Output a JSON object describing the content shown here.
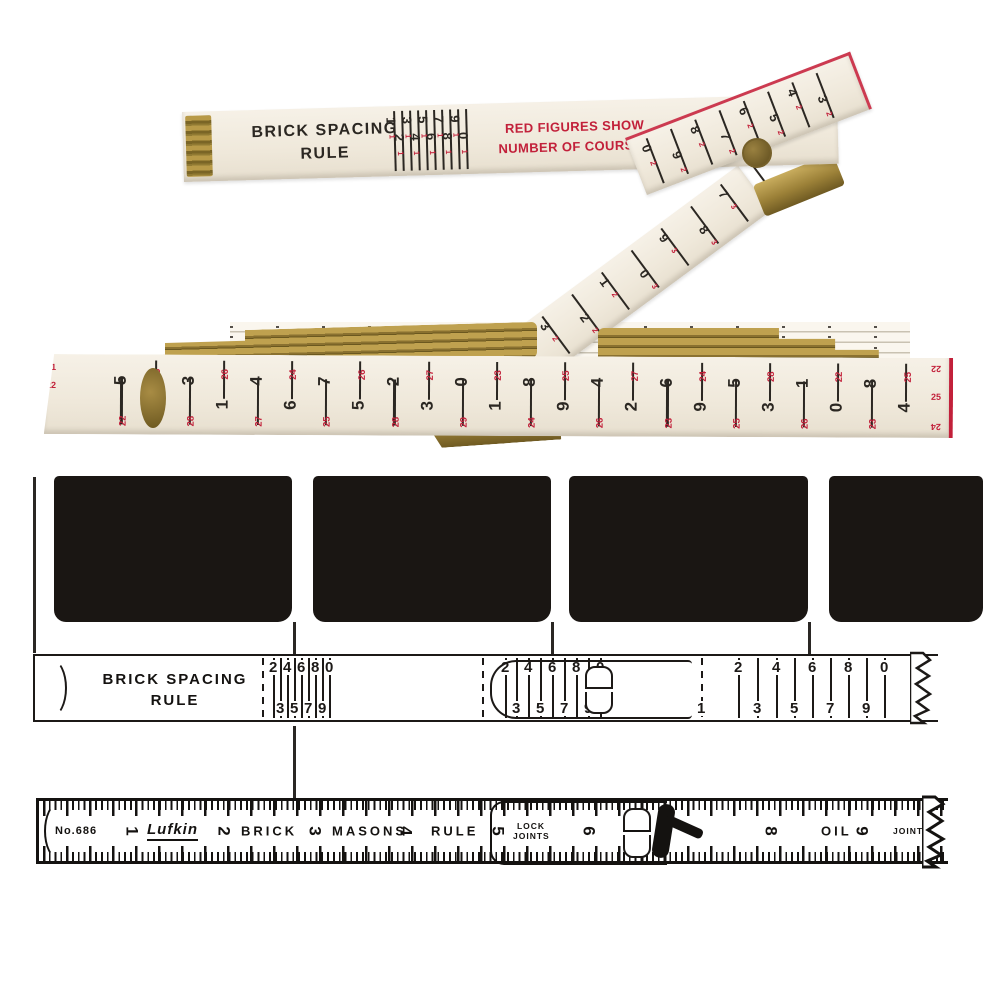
{
  "colors": {
    "ink": "#1c1917",
    "red": "#c2203a",
    "brass": "#a5893d",
    "cream": "#f2ecdf",
    "brick": "#1a1613"
  },
  "photo": {
    "title_line1": "BRICK SPACING",
    "title_line2": "RULE",
    "note_line1": "RED FIGURES SHOW",
    "note_line2": "NUMBER OF COURSES",
    "top_scale": [
      {
        "b": "1",
        "r": "1"
      },
      {
        "b": "2",
        "r": "1"
      },
      {
        "b": "3",
        "r": "1"
      },
      {
        "b": "4",
        "r": "1"
      },
      {
        "b": "5",
        "r": "1"
      },
      {
        "b": "6",
        "r": "1"
      },
      {
        "b": "7",
        "r": "1"
      },
      {
        "b": "8",
        "r": "1"
      },
      {
        "b": "9",
        "r": "1"
      },
      {
        "b": "0",
        "r": "1"
      }
    ],
    "fold_scale": [
      {
        "b": "0",
        "r": "2"
      },
      {
        "b": "9",
        "r": "2"
      },
      {
        "b": "8",
        "r": "2"
      },
      {
        "b": "7",
        "r": "2"
      },
      {
        "b": "6",
        "r": "2"
      },
      {
        "b": "5",
        "r": "2"
      },
      {
        "b": "4",
        "r": "2"
      },
      {
        "b": "3",
        "r": "2"
      }
    ],
    "diag_scale": [
      {
        "b": "5",
        "r": "2"
      },
      {
        "b": "4",
        "r": "2"
      },
      {
        "b": "3",
        "r": "2"
      },
      {
        "b": "2",
        "r": "2"
      },
      {
        "b": "1",
        "r": "2"
      },
      {
        "b": "0",
        "r": "3"
      },
      {
        "b": "9",
        "r": "3"
      },
      {
        "b": "8",
        "r": "3"
      },
      {
        "b": "7",
        "r": "3"
      },
      {
        "b": "6",
        "r": "3"
      }
    ],
    "stack_scale": [
      {
        "b": "5",
        "r": "22"
      },
      {
        "b": "1",
        "r": "25"
      },
      {
        "b": "3",
        "r": "28"
      },
      {
        "b": "1",
        "r": "26"
      },
      {
        "b": "4",
        "r": "27"
      },
      {
        "b": "6",
        "r": "24"
      },
      {
        "b": "7",
        "r": "25"
      },
      {
        "b": "5",
        "r": "26"
      },
      {
        "b": "2",
        "r": "28"
      },
      {
        "b": "3",
        "r": "27"
      },
      {
        "b": "0",
        "r": "29"
      },
      {
        "b": "1",
        "r": "23"
      },
      {
        "b": "8",
        "r": "24"
      },
      {
        "b": "9",
        "r": "25"
      },
      {
        "b": "4",
        "r": "26"
      },
      {
        "b": "2",
        "r": "27"
      },
      {
        "b": "6",
        "r": "23"
      },
      {
        "b": "9",
        "r": "24"
      },
      {
        "b": "5",
        "r": "25"
      },
      {
        "b": "3",
        "r": "28"
      },
      {
        "b": "1",
        "r": "26"
      },
      {
        "b": "0",
        "r": "22"
      },
      {
        "b": "8",
        "r": "23"
      },
      {
        "b": "4",
        "r": "25"
      }
    ],
    "stack_edge_left_1": "21",
    "stack_edge_left_2": "22",
    "stack_edge_right_1": "22",
    "stack_edge_right_2": "25",
    "stack_edge_right_3": "24"
  },
  "diagram_mid": {
    "label_line1": "BRICK SPACING",
    "label_line2": "RULE",
    "marks": [
      {
        "t": "",
        "x": 227,
        "kind": "dash"
      },
      {
        "t": "2",
        "x": 238,
        "kind": "t"
      },
      {
        "t": "3",
        "x": 245,
        "kind": "b"
      },
      {
        "t": "4",
        "x": 252,
        "kind": "t"
      },
      {
        "t": "5",
        "x": 259,
        "kind": "b"
      },
      {
        "t": "6",
        "x": 266,
        "kind": "t"
      },
      {
        "t": "7",
        "x": 273,
        "kind": "b"
      },
      {
        "t": "8",
        "x": 280,
        "kind": "t"
      },
      {
        "t": "9",
        "x": 287,
        "kind": "b"
      },
      {
        "t": "0",
        "x": 294,
        "kind": "t"
      },
      {
        "t": "",
        "x": 447,
        "kind": "dash"
      },
      {
        "t": "2",
        "x": 470,
        "kind": "t"
      },
      {
        "t": "3",
        "x": 481,
        "kind": "b"
      },
      {
        "t": "4",
        "x": 493,
        "kind": "t"
      },
      {
        "t": "5",
        "x": 505,
        "kind": "b"
      },
      {
        "t": "6",
        "x": 517,
        "kind": "t"
      },
      {
        "t": "7",
        "x": 529,
        "kind": "b"
      },
      {
        "t": "8",
        "x": 541,
        "kind": "t"
      },
      {
        "t": "9",
        "x": 553,
        "kind": "b"
      },
      {
        "t": "0",
        "x": 565,
        "kind": "t"
      },
      {
        "t": "1",
        "x": 666,
        "kind": "dash-b"
      },
      {
        "t": "2",
        "x": 703,
        "kind": "t"
      },
      {
        "t": "3",
        "x": 722,
        "kind": "b"
      },
      {
        "t": "4",
        "x": 741,
        "kind": "t"
      },
      {
        "t": "5",
        "x": 759,
        "kind": "b"
      },
      {
        "t": "6",
        "x": 777,
        "kind": "t"
      },
      {
        "t": "7",
        "x": 795,
        "kind": "b"
      },
      {
        "t": "8",
        "x": 813,
        "kind": "t"
      },
      {
        "t": "9",
        "x": 831,
        "kind": "b"
      },
      {
        "t": "0",
        "x": 849,
        "kind": "t"
      }
    ]
  },
  "diagram_bottom": {
    "items": [
      {
        "t": "No.686",
        "x": 16,
        "kind": "name"
      },
      {
        "t": "1",
        "x": 88,
        "kind": "rot"
      },
      {
        "t": "Lufkin",
        "x": 108,
        "kind": "script"
      },
      {
        "t": "2",
        "x": 180,
        "kind": "rot"
      },
      {
        "t": "BRICK",
        "x": 202,
        "kind": "word"
      },
      {
        "t": "3",
        "x": 271,
        "kind": "rot"
      },
      {
        "t": "MASONS",
        "x": 293,
        "kind": "word"
      },
      {
        "t": "4",
        "x": 362,
        "kind": "rot"
      },
      {
        "t": "RULE",
        "x": 392,
        "kind": "word"
      },
      {
        "t": "5",
        "x": 454,
        "kind": "rot"
      },
      {
        "t": "LOCK JOINTS",
        "x": 474,
        "kind": "small"
      },
      {
        "t": "6",
        "x": 545,
        "kind": "rot"
      },
      {
        "t": "8",
        "x": 727,
        "kind": "rot"
      },
      {
        "t": "OIL",
        "x": 782,
        "kind": "word"
      },
      {
        "t": "9",
        "x": 818,
        "kind": "rot"
      },
      {
        "t": "JOINTS",
        "x": 854,
        "kind": "small"
      }
    ]
  }
}
